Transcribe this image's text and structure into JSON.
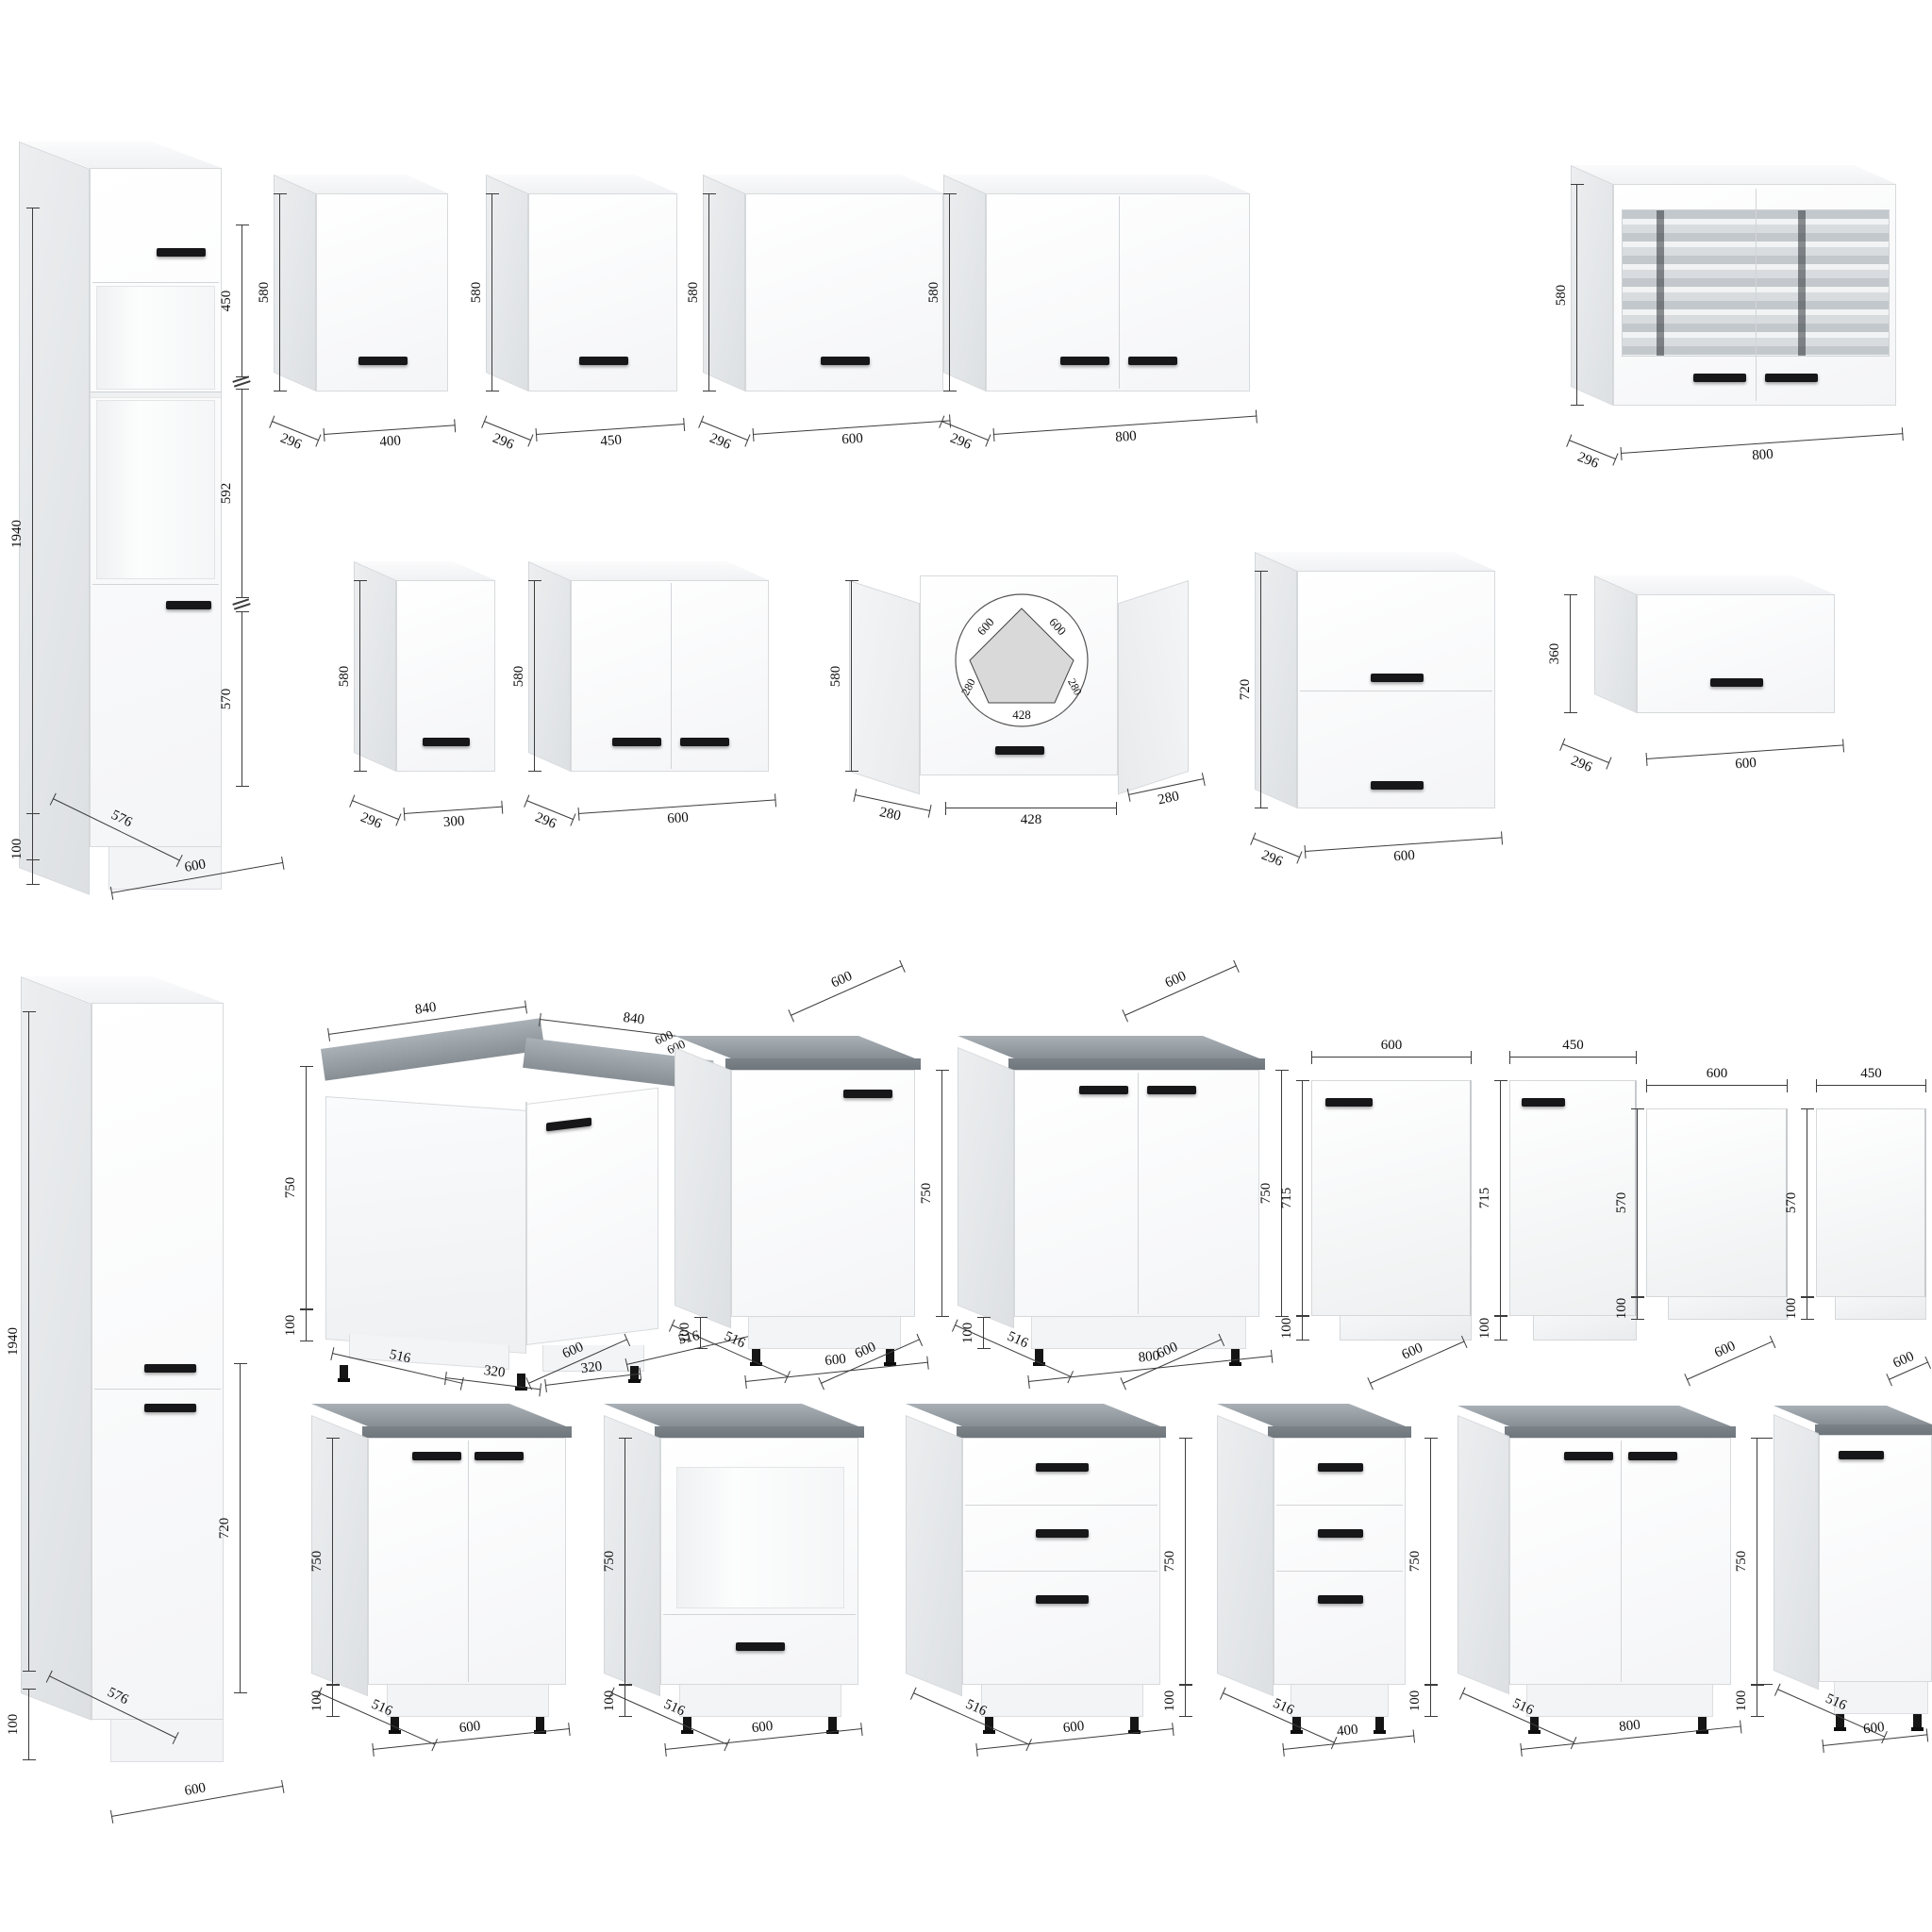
{
  "palette": {
    "cabinet_white": "#ffffff",
    "side_shade": "#e9ebed",
    "counter_gray": "#8e959b",
    "handle_black": "#17171a",
    "dim_line": "#3c3c3c",
    "glass_gray": "#c3c8cc"
  },
  "u": {
    "t1": {
      "h": "1940",
      "s1": "450",
      "s2": "592",
      "s3": "570",
      "plinth": "100",
      "depth": "576",
      "w": "600"
    },
    "w400": {
      "h": "580",
      "d": "296",
      "w": "400"
    },
    "w450": {
      "h": "580",
      "d": "296",
      "w": "450"
    },
    "w600": {
      "h": "580",
      "d": "296",
      "w": "600"
    },
    "w800": {
      "h": "580",
      "d": "296",
      "w": "800"
    },
    "w800g": {
      "h": "580",
      "d": "296",
      "w": "800"
    },
    "w300": {
      "h": "580",
      "d": "296",
      "w": "300"
    },
    "w600b": {
      "h": "580",
      "d": "296",
      "w": "600"
    },
    "wc": {
      "h": "580",
      "b_left": "280",
      "b_center": "428",
      "b_right": "280",
      "plan_left": "600",
      "plan_right": "600",
      "plan_bl": "280",
      "plan_br": "280",
      "plan_front": "428"
    },
    "w720": {
      "h": "720",
      "d": "296",
      "w": "600"
    },
    "w360": {
      "h": "360",
      "d": "296",
      "w": "600"
    },
    "t2": {
      "h": "1940",
      "s": "720",
      "plinth": "100",
      "depth": "576",
      "w": "600"
    },
    "bc": {
      "t1": "840",
      "t2": "840",
      "t3": "600",
      "t4": "600",
      "h": "750",
      "plinth": "100",
      "b1": "516",
      "b2": "320",
      "b3": "320",
      "b4": "516"
    },
    "b600": {
      "t": "600",
      "h": "750",
      "d": "516",
      "plinth": "100",
      "w": "600"
    },
    "b800": {
      "t": "600",
      "h": "750",
      "d": "516",
      "plinth": "100",
      "w": "800"
    },
    "p1": {
      "w": "600",
      "h": "715",
      "plinth": "100"
    },
    "p2": {
      "w": "450",
      "h": "715",
      "plinth": "100"
    },
    "p3": {
      "w": "600",
      "h": "570",
      "plinth": "100"
    },
    "p4": {
      "w": "450",
      "h": "570",
      "plinth": "100"
    },
    "b600x2": {
      "t": "600",
      "h": "750",
      "d": "516",
      "plinth": "100",
      "w": "600"
    },
    "bov": {
      "t": "600",
      "h": "750",
      "d": "516",
      "plinth": "100",
      "w": "600"
    },
    "bd600": {
      "t": "600",
      "h": "750",
      "d": "516",
      "plinth": "100",
      "w": "600"
    },
    "bd400": {
      "t": "600",
      "h": "750",
      "d": "516",
      "plinth": "100",
      "w": "400"
    },
    "b800x2": {
      "t": "600",
      "h": "750",
      "d": "516",
      "plinth": "100",
      "w": "800"
    },
    "b600s": {
      "t": "600",
      "h": "750",
      "d": "516",
      "plinth": "100",
      "w": "600"
    }
  }
}
